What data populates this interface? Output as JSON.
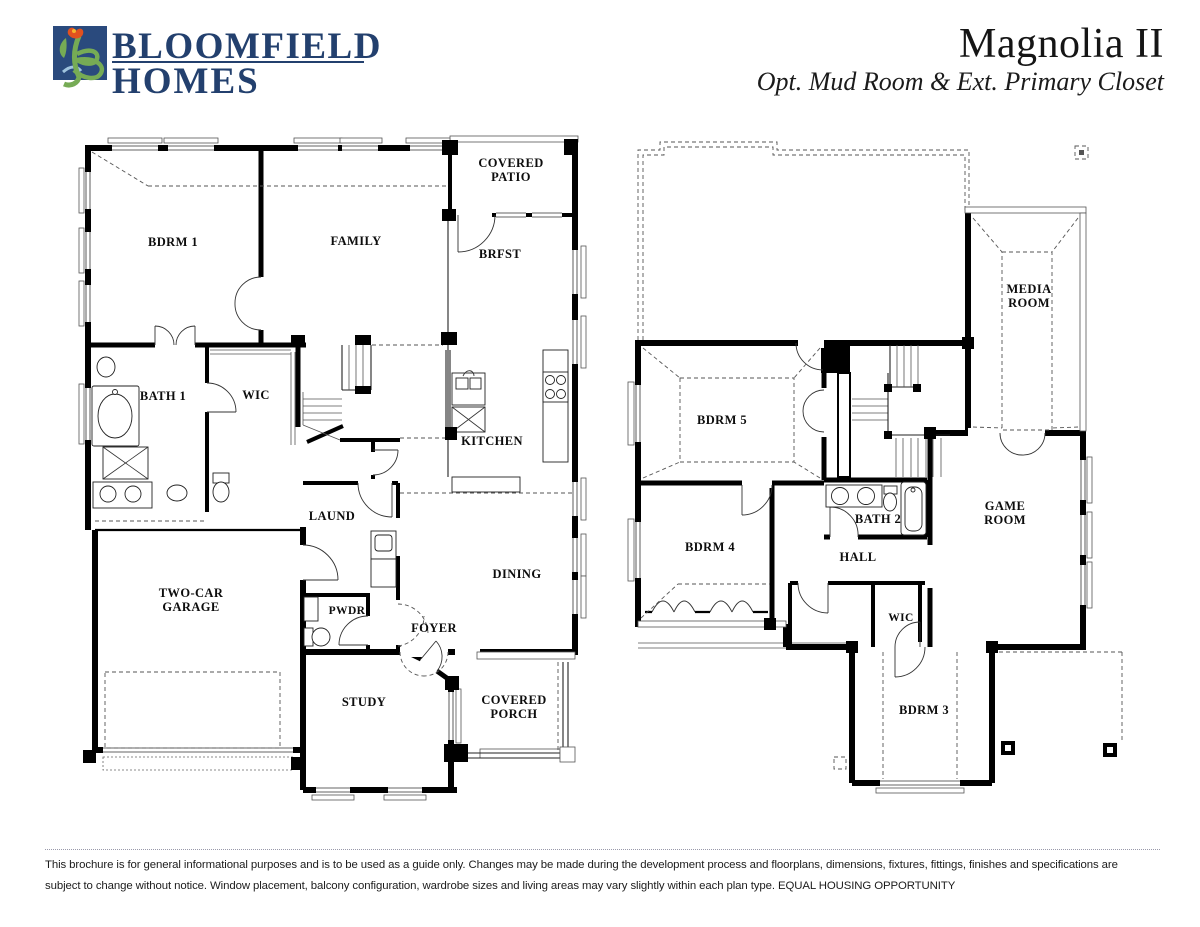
{
  "header": {
    "brand": {
      "line1": "BLOOMFIELD",
      "line2": "HOMES"
    },
    "plan_name": "Magnolia II",
    "plan_option": "Opt. Mud Room & Ext. Primary Closet"
  },
  "colors": {
    "logo_square": "#2a4a7d",
    "logo_plant": "#76ab55",
    "logo_tulip": "#e2511f",
    "brand_navy": "#23406e",
    "wall": "#000000"
  },
  "floor1": {
    "rooms": {
      "covered_patio": [
        "COVERED",
        "PATIO"
      ],
      "bdrm1": [
        "BDRM 1"
      ],
      "family": [
        "FAMILY"
      ],
      "brfst": [
        "BRFST"
      ],
      "bath1": [
        "BATH 1"
      ],
      "wic": [
        "WIC"
      ],
      "kitchen": [
        "KITCHEN"
      ],
      "laund": [
        "LAUND"
      ],
      "dining": [
        "DINING"
      ],
      "pwdr": [
        "PWDR"
      ],
      "foyer": [
        "FOYER"
      ],
      "garage": [
        "TWO-CAR",
        "GARAGE"
      ],
      "study": [
        "STUDY"
      ],
      "covered_porch": [
        "COVERED",
        "PORCH"
      ]
    }
  },
  "floor2": {
    "rooms": {
      "media_room": [
        "MEDIA",
        "ROOM"
      ],
      "bdrm5": [
        "BDRM 5"
      ],
      "bdrm4": [
        "BDRM 4"
      ],
      "bath2": [
        "BATH 2"
      ],
      "hall": [
        "HALL"
      ],
      "game_room": [
        "GAME",
        "ROOM"
      ],
      "wic": [
        "WIC"
      ],
      "bdrm3": [
        "BDRM 3"
      ]
    }
  },
  "footer": {
    "disclaimer_line1": "This brochure is for general informational purposes and is to be used as a guide only. Changes may be made during the development process and floorplans, dimensions, fixtures, fittings, finishes and specifications are",
    "disclaimer_line2": "subject to change without notice. Window placement, balcony configuration, wardrobe sizes and living areas may vary slightly within each plan type.  EQUAL HOUSING OPPORTUNITY"
  }
}
